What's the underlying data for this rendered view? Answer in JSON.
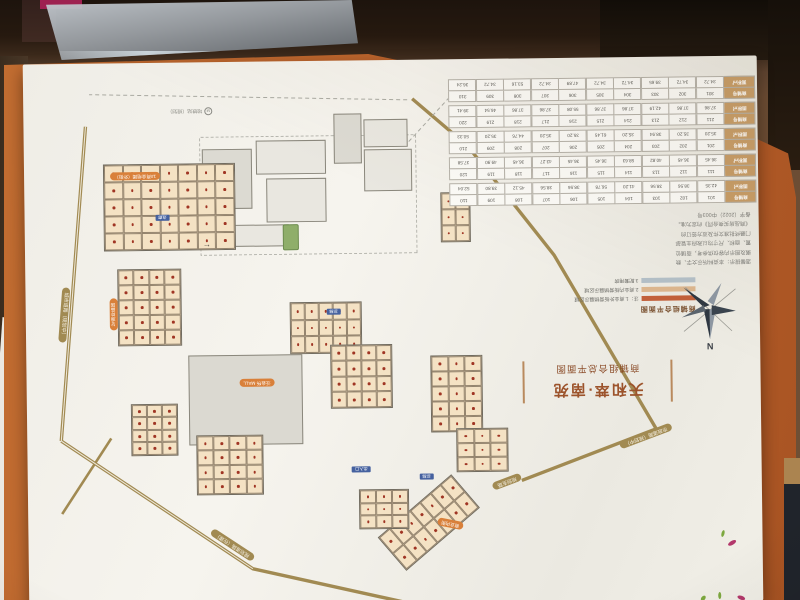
{
  "poster": {
    "title": {
      "project": "天和萃·南苑",
      "subtitle": "商铺组合总平面图"
    },
    "legend": {
      "caption": "商铺组合平面图",
      "note_items": [
        {
          "label": "注：1.商业外街营销展示区域",
          "color": "#c2603a"
        },
        {
          "label": "2.商业内街营销展示区域",
          "color": "#dcb68e"
        },
        {
          "label": "3.配套用房",
          "color": "#b3bfc7"
        }
      ]
    },
    "compass": {
      "label": "N"
    },
    "disclaimer": {
      "lines": [
        "温馨提示：本资料所示文字、数",
        "据及图示内容仅供参考，商铺位",
        "置、面积、尺寸均以政府主管部",
        "门最终批准文件及双方签订的",
        "《商品房买卖合同》约定为准。",
        "备字（2022）中003号"
      ]
    },
    "unit_table": {
      "row_headers": {
        "shop": "商铺号",
        "area": "面积㎡"
      },
      "groups": [
        {
          "nums": [
            "101",
            "102",
            "103",
            "104",
            "105",
            "106",
            "107",
            "108",
            "109",
            "110"
          ],
          "areas": [
            "42.35",
            "38.56",
            "38.56",
            "41.20",
            "56.78",
            "38.56",
            "38.56",
            "45.12",
            "39.80",
            "52.04"
          ]
        },
        {
          "nums": [
            "111",
            "112",
            "113",
            "114",
            "115",
            "116",
            "117",
            "118",
            "119",
            "120"
          ],
          "areas": [
            "36.45",
            "36.45",
            "40.82",
            "58.63",
            "36.45",
            "36.45",
            "43.27",
            "36.45",
            "49.90",
            "37.58"
          ]
        },
        {
          "nums": [
            "201",
            "202",
            "203",
            "204",
            "205",
            "206",
            "207",
            "208",
            "209",
            "210"
          ],
          "areas": [
            "35.20",
            "35.20",
            "38.94",
            "35.20",
            "61.45",
            "35.20",
            "35.20",
            "44.76",
            "35.20",
            "50.33"
          ]
        },
        {
          "nums": [
            "211",
            "212",
            "213",
            "214",
            "215",
            "216",
            "217",
            "218",
            "219",
            "220"
          ],
          "areas": [
            "37.86",
            "37.86",
            "42.19",
            "37.86",
            "37.86",
            "55.08",
            "37.86",
            "37.86",
            "46.54",
            "39.41"
          ]
        },
        {
          "nums": [
            "301",
            "302",
            "303",
            "304",
            "305",
            "306",
            "307",
            "308",
            "309",
            "310"
          ],
          "areas": [
            "34.72",
            "34.72",
            "39.65",
            "34.72",
            "34.72",
            "47.89",
            "34.72",
            "53.16",
            "34.72",
            "36.24"
          ]
        }
      ]
    },
    "map": {
      "road_labels": [
        "规划道路（在建）",
        "城市道路（规划中）",
        "市政道路（规划中）",
        "规划支路"
      ],
      "cluster_labels": [
        "1#商业组团（外街）",
        "2#商业组团",
        "商业内街",
        "泛会所·MALL"
      ],
      "blue_tags": [
        "扶梯",
        "连廊",
        "扶梯",
        "出入口"
      ],
      "metro_label": "地铁站（规划）",
      "arrow": "←",
      "colors": {
        "road_gold": "#a18a52",
        "unit_fill": "#f4e2c4",
        "unit_mark": "#a03524",
        "tag_orange": "#d9803a",
        "tag_blue": "#45619f",
        "sheet_orange": "#b9612b"
      }
    }
  }
}
